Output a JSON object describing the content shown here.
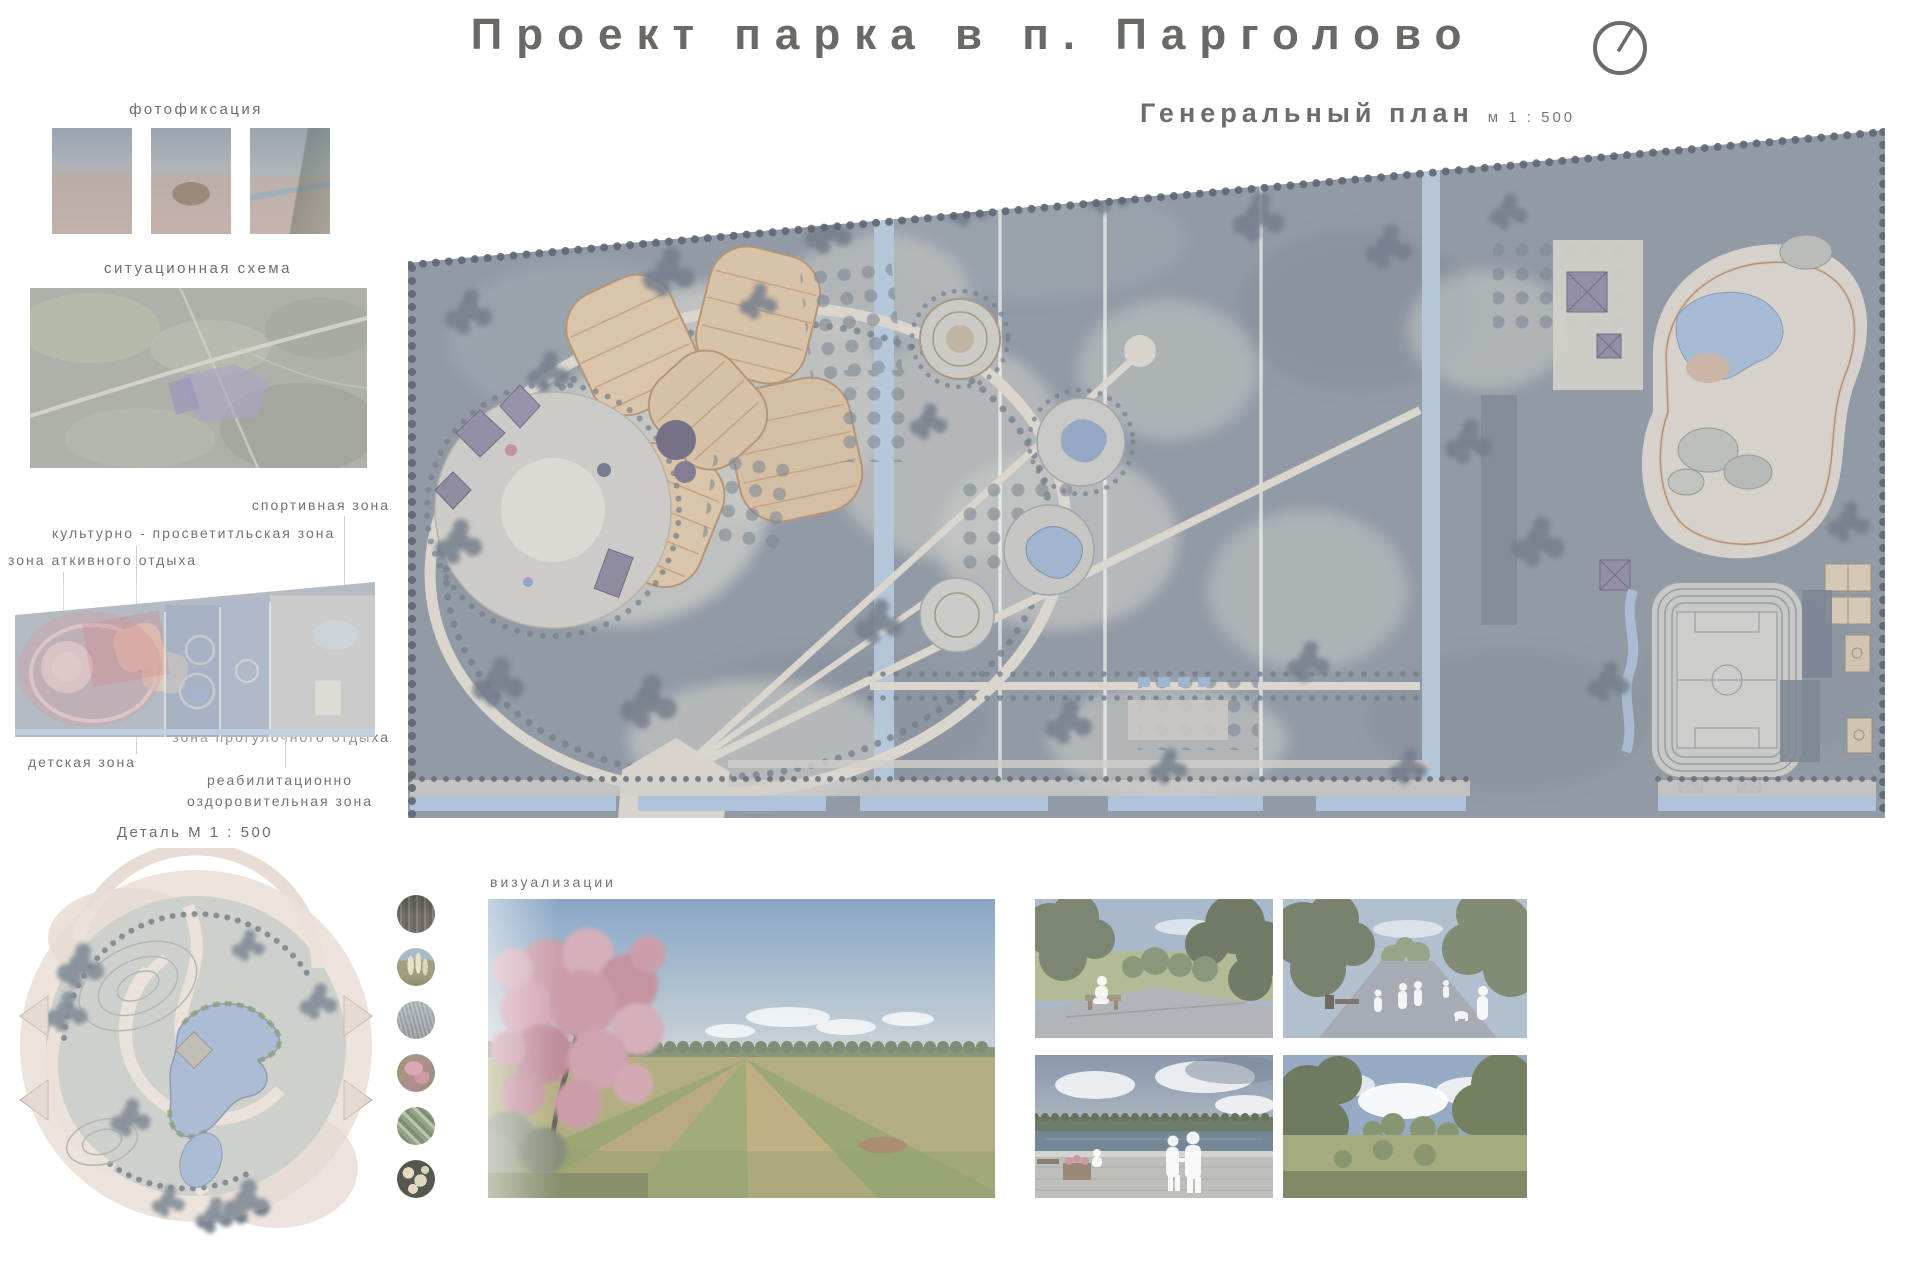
{
  "title": "Проект парка в п. Парголово",
  "general_plan": {
    "label": "Генеральный план",
    "scale": "м 1 : 500"
  },
  "photofixation": {
    "label": "фотофиксация"
  },
  "situation_scheme": {
    "label": "ситуационная схема"
  },
  "zones": {
    "sport": "спортивная зона",
    "cultural": "культурно - просветитльская зона",
    "active": "зона аткивного отдыха",
    "walking": "зона прогулочного отдыха",
    "children": "детская зона",
    "rehab_line1": "реабилитационно",
    "rehab_line2": "оздоровительная зона"
  },
  "detail": {
    "label": "Деталь  М  1 : 500"
  },
  "visualizations": {
    "label": "визуализации"
  },
  "icons": {
    "north_arrow": "circle-with-needle"
  },
  "colors": {
    "text": "#6F6C69",
    "plan_background": "#8C95A1",
    "plan_clearing": "#C7C8C4",
    "plan_path": "#D9D4CC",
    "water": "#A9BDD6",
    "orchard_beige": "#D6C1A6",
    "pavilion_purple": "#8F8AA4",
    "zone_pink": "#C2707E",
    "zone_blue": "#7F9CC4",
    "tree_dark": "#6E7886"
  }
}
